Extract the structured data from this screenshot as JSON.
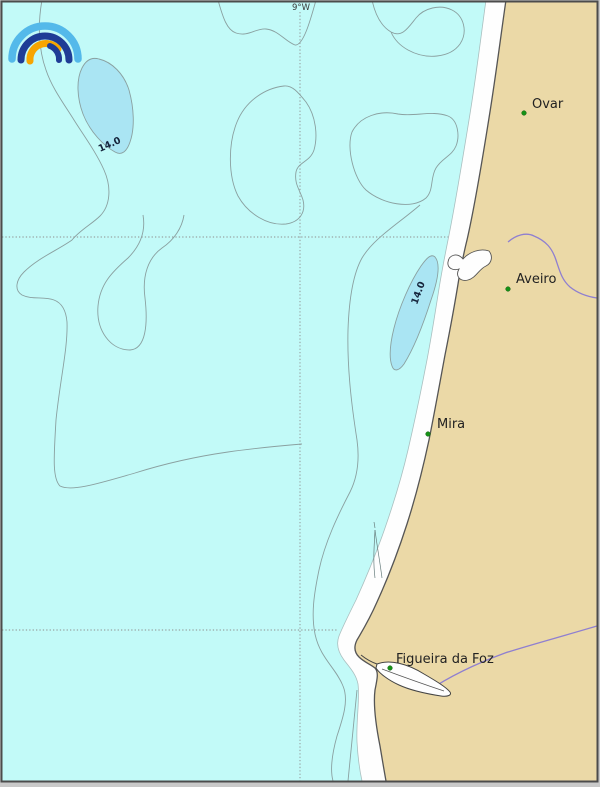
{
  "map": {
    "title": "Coastal nautical chart - Aveiro region, Portugal",
    "graticule": {
      "meridian_label": "9°W"
    },
    "depth_contours": [
      {
        "label": "14.0"
      },
      {
        "label": "14.0"
      }
    ],
    "cities": [
      {
        "name": "Ovar"
      },
      {
        "name": "Aveiro"
      },
      {
        "name": "Mira"
      },
      {
        "name": "Figueira da Foz"
      }
    ],
    "colors": {
      "sea": "#c2faf8",
      "shoal": "#aae5f3",
      "land": "#ebd9a7",
      "beach": "#fefefe",
      "contour": "#8aa0a0",
      "coastline": "#555555",
      "river": "#8f7fd0",
      "grid": "#8d8d8d",
      "city_dot": "#169116",
      "frame": "#4c4c4c",
      "page_background": "#c9c9c9"
    },
    "logo": {
      "name": "open-meteo-rainbow-logo",
      "arc_colors": {
        "outer": "#54b9ea",
        "middle": "#1f3c96",
        "inner": "#f7a500"
      }
    }
  }
}
